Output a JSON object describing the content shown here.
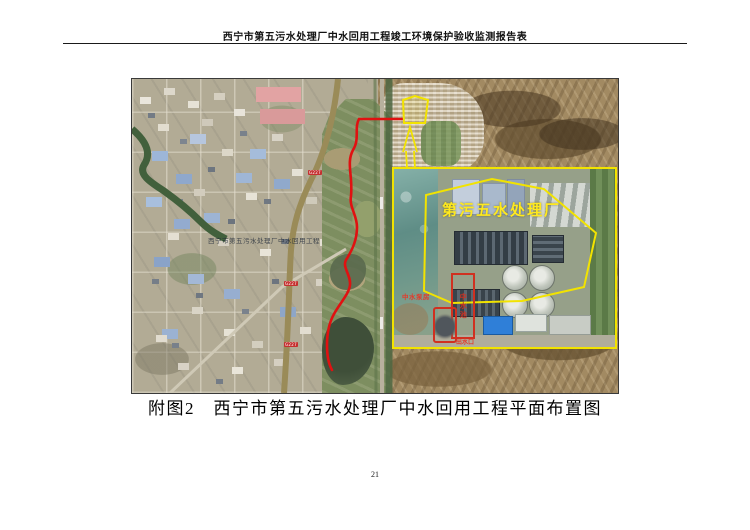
{
  "header": {
    "title": "西宁市第五污水处理厂中水回用工程竣工环境保护验收监测报告表"
  },
  "figure": {
    "caption": "附图2　西宁市第五污水处理厂中水回用工程平面布置图",
    "map": {
      "watermark": "西宁市第五污水处理厂中水回用工程",
      "badges": [
        {
          "label": "G227"
        },
        {
          "label": "G227"
        },
        {
          "label": "G227"
        }
      ],
      "inset": {
        "title": "第污五水处理厂",
        "labels": {
          "pump_station": "中水泵房",
          "reuse_tank": "中水池",
          "outlet": "出水口"
        }
      },
      "colors": {
        "route_line": "#e01111",
        "highlight_outline": "#f2e300",
        "road_badge": "#c53030"
      }
    }
  },
  "footer": {
    "page_number": "21"
  }
}
